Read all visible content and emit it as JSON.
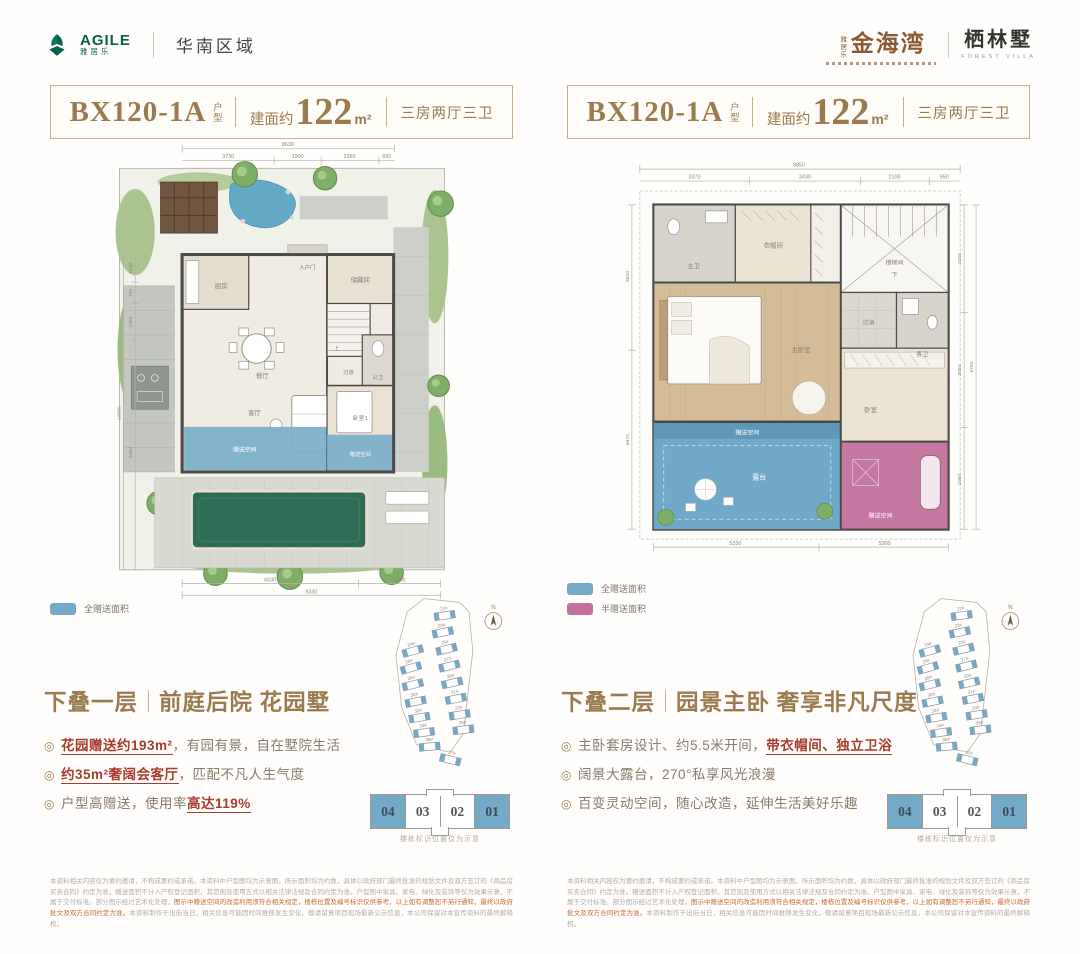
{
  "header": {
    "brand_left": {
      "name": "AGILE",
      "name_cn": "雅居乐",
      "region": "华南区域"
    },
    "brand_right": {
      "prefix_vertical": "雅居乐",
      "project": "金海湾",
      "villa": "栖林墅",
      "villa_en": "FOREST VILLA"
    }
  },
  "sitemap": {
    "compass": "N",
    "buildings": [
      "22#",
      "23#",
      "25#",
      "27#",
      "29#",
      "31#",
      "33#",
      "35#",
      "37#",
      "24#",
      "26#",
      "28#",
      "30#",
      "32#",
      "34#",
      "36#"
    ],
    "units": [
      "04",
      "03",
      "02",
      "01"
    ],
    "caption": "楼栋标识位置仅为示意"
  },
  "disclaimer": {
    "p1": "本资料相关内容仅为要约邀请，不构成要约或承诺。本资料中户型图均为示意图，所示面积均为约数，具体以政府部门最终批准的规划文件及双方签订的《商品房买卖合同》约定为准。赠送面积不计入产权登记面积，其范围及使用方式以相关法律法规及合同约定为准。户型图中家具、家电、绿化及装饰等仅为效果示意，不属于交付标准。部分图示经过艺术化处理，",
    "em": "图示中赠送空间的改造利用须符合相关规定，楼栋位置及编号标识仅供参考，以上如有调整恕不另行通知，最终以政府批文及双方合同约定为准。",
    "p2": "本资料制作于出街当日，相关信息可能因时间推移发生变化，敬请留意项目现场最新公示信息，本公司保留对本宣传资料的最终解释权。"
  },
  "panels": [
    {
      "badge": {
        "model": "BX120-1A",
        "suffix": "户型",
        "area_label": "建面约",
        "area": "122",
        "unit": "m²",
        "layout": "三房两厅三卫"
      },
      "legend": [
        {
          "label": "全赠送面积",
          "color": "#74A9C8"
        }
      ],
      "title": {
        "floor": "下叠一层",
        "desc": "前庭后院 花园墅"
      },
      "bullets": [
        {
          "pre": "",
          "strong": "花园赠送约193m²",
          "post": "，有园有景，自在墅院生活"
        },
        {
          "pre": "",
          "strong": "约35m²奢阔会客厅",
          "post": "，匹配不凡人生气度"
        },
        {
          "pre": "户型高赠送，使用率",
          "strong": "高达119%",
          "post": ""
        }
      ],
      "plan": {
        "rooms": {
          "kitchen": "厨房",
          "entry": "入户门",
          "storage": "储藏间",
          "dining": "餐厅",
          "up": "上",
          "corridor": "过道",
          "bath": "公卫",
          "living": "客厅",
          "bed1": "卧室1",
          "gift_living": "赠送空间",
          "gift_bed": "赠送空间"
        },
        "dims": {
          "top_total": "8630",
          "top": [
            "3730",
            "1900",
            "2350",
            "650"
          ],
          "left_total": "10550",
          "left": [
            "1030",
            "750",
            "1380",
            "6450"
          ],
          "bottom": [
            "6030",
            "3300"
          ],
          "bottom_total": "9330"
        }
      }
    },
    {
      "badge": {
        "model": "BX120-1A",
        "suffix": "户型",
        "area_label": "建面约",
        "area": "122",
        "unit": "m²",
        "layout": "三房两厅三卫"
      },
      "legend": [
        {
          "label": "全赠送面积",
          "color": "#74A9C8"
        },
        {
          "label": "半赠送面积",
          "color": "#C2719B"
        }
      ],
      "title": {
        "floor": "下叠二层",
        "desc": "园景主卧 奢享非凡尺度"
      },
      "bullets": [
        {
          "pre": "主卧套房设计、约5.5米开间，",
          "strong": "带衣帽间、独立卫浴",
          "post": ""
        },
        {
          "pre": "阔景大露台，270°私享风光浪漫",
          "strong": "",
          "post": ""
        },
        {
          "pre": "百变灵动空间，随心改造，延伸生活美好乐趣",
          "strong": "",
          "post": ""
        }
      ],
      "plan": {
        "rooms": {
          "mbath": "主卫",
          "closet": "衣帽间",
          "stair": "楼梯间",
          "down": "下",
          "corridor": "过道",
          "mbed": "主卧室",
          "terrace": "露台",
          "gift_terrace": "赠送空间",
          "bed": "卧室",
          "gbath": "客卫",
          "gift_pink": "赠送空间"
        },
        "dims": {
          "top_total": "9850",
          "top": [
            "3370",
            "3430",
            "2100",
            "950"
          ],
          "right_total": "8750",
          "right": [
            "3150",
            "3550",
            "2050"
          ],
          "left": [
            "3620",
            "6870"
          ],
          "bottom": [
            "5330",
            "5300"
          ]
        }
      }
    }
  ],
  "colors": {
    "accent_gold": "#9B7B4D",
    "brand_green": "#06604B",
    "logo_brown": "#8A5A33",
    "gift_blue": "#74A9C8",
    "gift_pink": "#C2719B",
    "highlight_red": "#A83B2C",
    "pool_green": "#2F6C55"
  }
}
